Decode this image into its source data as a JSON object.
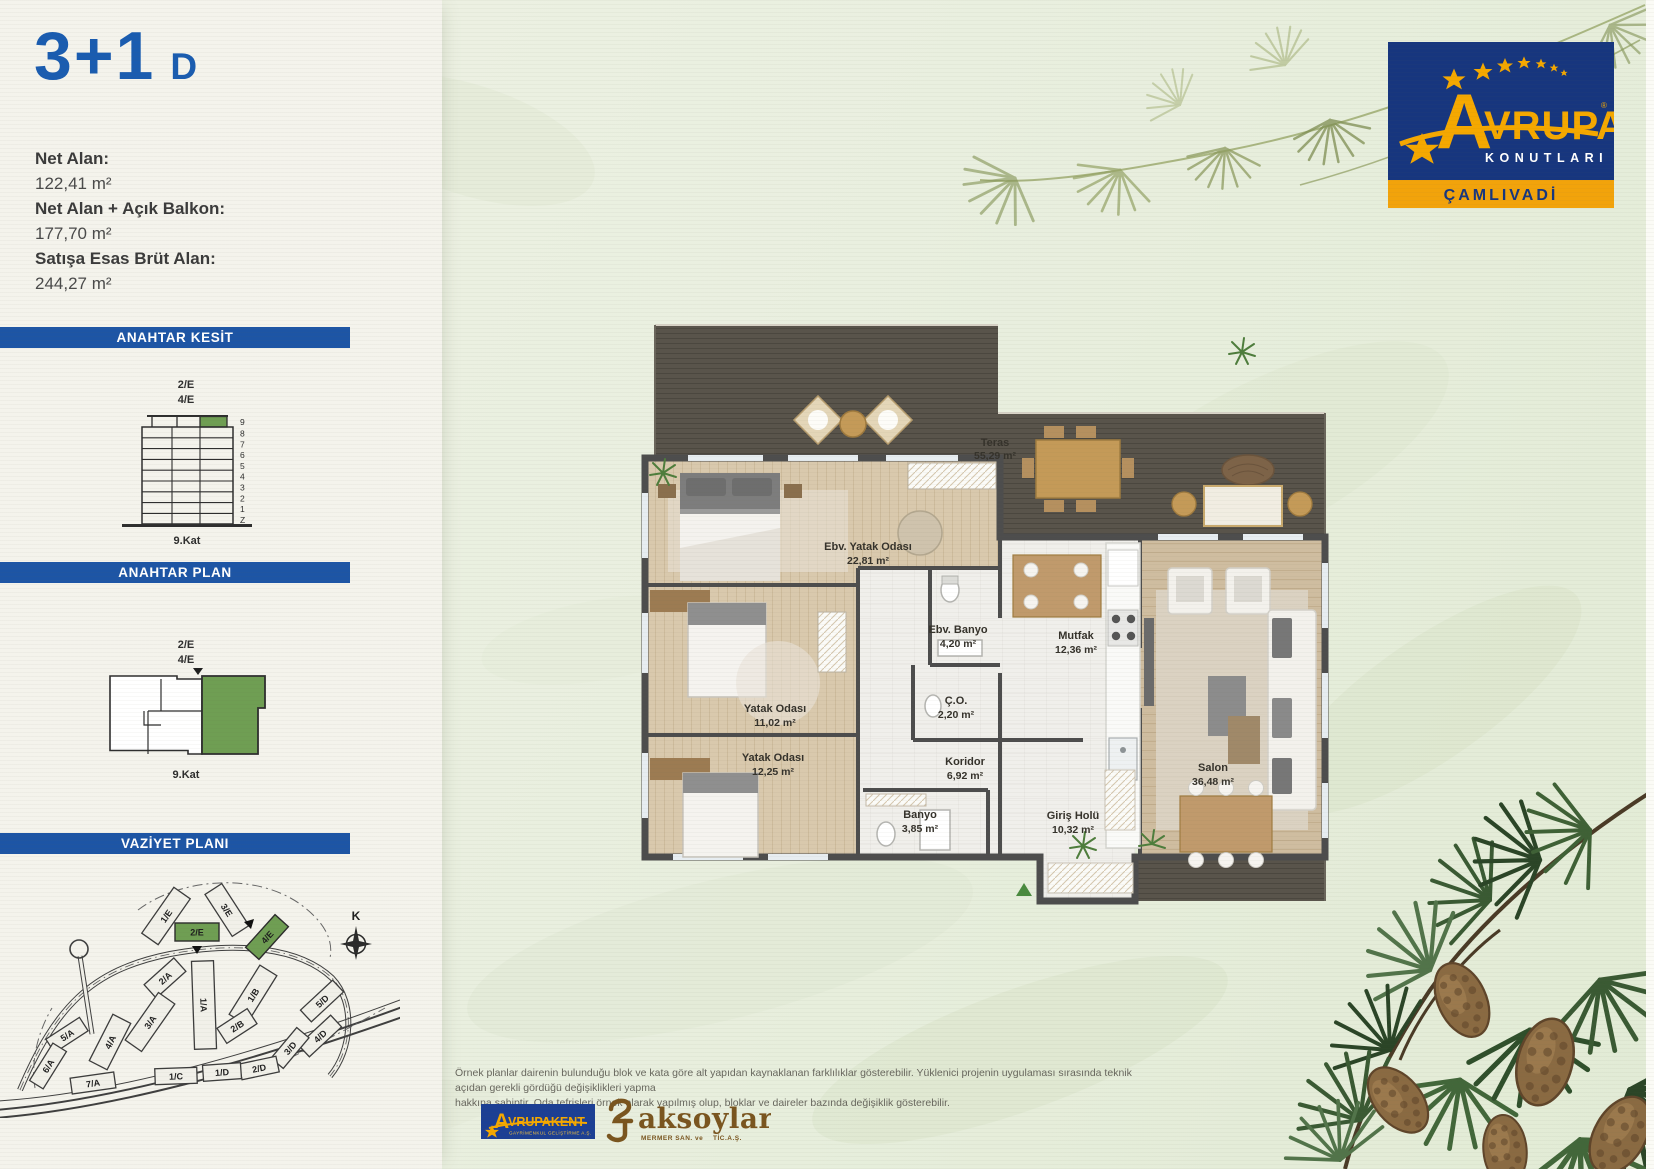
{
  "unit": {
    "type": "3+1",
    "variant": "D"
  },
  "stats": [
    {
      "label": "Net Alan:",
      "value": "122,41 m²"
    },
    {
      "label": "Net Alan + Açık Balkon:",
      "value": "177,70 m²"
    },
    {
      "label": "Satışa Esas Brüt Alan:",
      "value": "244,27 m²"
    }
  ],
  "sections": {
    "kesit": "ANAHTAR KESİT",
    "plan": "ANAHTAR PLAN",
    "vaziyet": "VAZİYET PLANI"
  },
  "kesit": {
    "block_label_top": "2/E",
    "block_label_bottom": "4/E",
    "floors": [
      "9",
      "8",
      "7",
      "6",
      "5",
      "4",
      "3",
      "2",
      "1",
      "Z"
    ],
    "caption": "9.Kat"
  },
  "key_plan": {
    "block_label_top": "2/E",
    "block_label_bottom": "4/E",
    "caption": "9.Kat"
  },
  "site_plan": {
    "compass_label": "K",
    "buildings": [
      {
        "id": "1/E",
        "highlighted": false
      },
      {
        "id": "3/E",
        "highlighted": false
      },
      {
        "id": "2/E",
        "highlighted": true
      },
      {
        "id": "4/E",
        "highlighted": true
      },
      {
        "id": "2/A",
        "highlighted": false
      },
      {
        "id": "1/A",
        "highlighted": false
      },
      {
        "id": "1/B",
        "highlighted": false
      },
      {
        "id": "2/B",
        "highlighted": false
      },
      {
        "id": "3/A",
        "highlighted": false
      },
      {
        "id": "4/A",
        "highlighted": false
      },
      {
        "id": "5/A",
        "highlighted": false
      },
      {
        "id": "6/A",
        "highlighted": false
      },
      {
        "id": "7/A",
        "highlighted": false
      },
      {
        "id": "5/D",
        "highlighted": false
      },
      {
        "id": "4/D",
        "highlighted": false
      },
      {
        "id": "3/D",
        "highlighted": false
      },
      {
        "id": "2/D",
        "highlighted": false
      },
      {
        "id": "1/D",
        "highlighted": false
      },
      {
        "id": "1/C",
        "highlighted": false
      }
    ]
  },
  "floor_plan": {
    "rooms": [
      {
        "name": "Teras",
        "area": "55,29 m²"
      },
      {
        "name": "Ebv. Yatak Odası",
        "area": "22,81 m²"
      },
      {
        "name": "Ebv. Banyo",
        "area": "4,20 m²"
      },
      {
        "name": "Mutfak",
        "area": "12,36 m²"
      },
      {
        "name": "Yatak Odası",
        "area": "11,02 m²"
      },
      {
        "name": "Ç.O.",
        "area": "2,20 m²"
      },
      {
        "name": "Yatak Odası",
        "area": "12,25 m²"
      },
      {
        "name": "Koridor",
        "area": "6,92 m²"
      },
      {
        "name": "Banyo",
        "area": "3,85 m²"
      },
      {
        "name": "Giriş Holü",
        "area": "10,32 m²"
      },
      {
        "name": "Salon",
        "area": "36,48 m²"
      }
    ]
  },
  "brand": {
    "initial": "A",
    "rest": "VRUPA",
    "registered": "®",
    "sub": "KONUTLARI",
    "project": "ÇAMLIVADİ"
  },
  "footer": {
    "disclaimer_line1": "Örnek planlar dairenin bulunduğu blok ve kata göre alt yapıdan kaynaklanan farklılıklar gösterebilir. Yüklenici projenin uygulaması sırasında teknik açıdan gerekli gördüğü değişiklikleri yapma",
    "disclaimer_line2": "hakkına sahiptir. Oda tefrişleri örnek olarak yapılmış olup, bloklar ve daireler bazında değişiklik gösterebilir.",
    "partner1": {
      "initial": "A",
      "rest": "VRUPAKENT",
      "sub": "GAYRİMENKUL GELİŞTİRME A.Ş."
    },
    "partner2": {
      "name": "aksoylar",
      "sub1": "MERMER SAN. ve",
      "sub2": "TİC.A.Ş."
    }
  },
  "colors": {
    "accent_blue": "#1d55a5",
    "title_blue": "#1a5cb0",
    "highlight_green": "#6f9e53",
    "logo_navy": "#17367e",
    "logo_yellow": "#f5a800",
    "band_orange": "#f2a30b",
    "aksoylar_brown": "#7a551f"
  }
}
